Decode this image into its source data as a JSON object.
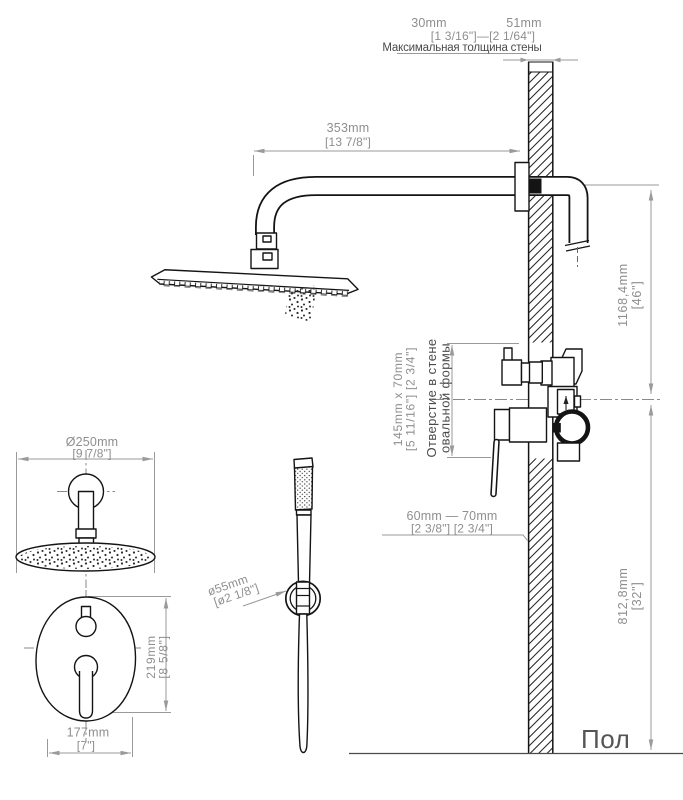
{
  "diagram": {
    "wall_thickness": {
      "min_mm": "30mm",
      "max_mm": "51mm",
      "inches": "[1 3/16\"]—[2 1/64\"]",
      "caption": "Максимальная толщина стены"
    },
    "arm_length": {
      "mm": "353mm",
      "in": "[13 7/8\"]"
    },
    "height_upper": {
      "mm": "1168,4mm",
      "in": "[46\"]"
    },
    "height_lower": {
      "mm": "812,8mm",
      "in": "[32\"]"
    },
    "wall_hole": {
      "mm": "145mm  x  70mm",
      "in": "[5 11/16\"]  [2 3/4\"]",
      "caption_line1": "Отверстие в стене",
      "caption_line2": "овальной формы"
    },
    "valve_depth": {
      "mm": "60mm — 70mm",
      "in": "[2 3/8\"]  [2 3/4\"]"
    },
    "head_diameter": {
      "mm": "Ø250mm",
      "in": "[9 7/8\"]"
    },
    "trim_height": {
      "mm": "219mm",
      "in": "[8 5/8\"]"
    },
    "trim_width": {
      "mm": "177mm",
      "in": "[7\"]"
    },
    "holder_diameter": {
      "mm": "ø55mm",
      "in": "[ø2 1/8\"]"
    },
    "floor_label": "Пол"
  },
  "colors": {
    "background": "#ffffff",
    "drawing_line": "#141414",
    "dimension_line": "#9a9a9a",
    "dimension_text": "#8e8e8e",
    "caption_text": "#4a4a4a"
  }
}
